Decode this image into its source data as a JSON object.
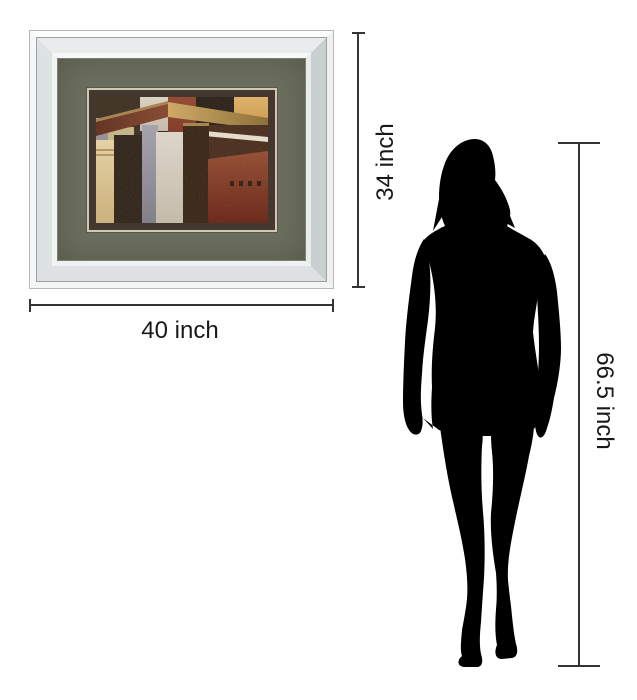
{
  "page": {
    "background_color": "#ffffff",
    "description": "Product size diagram: mirror-framed abstract art print shown to scale beside a female silhouette"
  },
  "dimensions": {
    "width_label": "40 inch",
    "height_label": "34 inch",
    "person_height_label": "66.5 inch",
    "line_color": "#343434",
    "label_color": "#191919"
  },
  "framed_print": {
    "frame_style": "mirror-frame",
    "frame_color": "#eef1f2",
    "mat_color": "#6c6f5d",
    "liner_color": "#44372d",
    "artwork_style": "abstract geometric block painting",
    "artwork_colors": [
      "#3a2b1b",
      "#d5cbba",
      "#8c3a22",
      "#251c12",
      "#d9a54e",
      "#9b96a0",
      "#c6b685",
      "#e0cb98",
      "#2b1f13",
      "#8f8d97",
      "#d8cfc2",
      "#34200f",
      "#7e3120",
      "#e8dfce"
    ]
  },
  "person": {
    "type": "female-silhouette",
    "color": "#000000"
  }
}
